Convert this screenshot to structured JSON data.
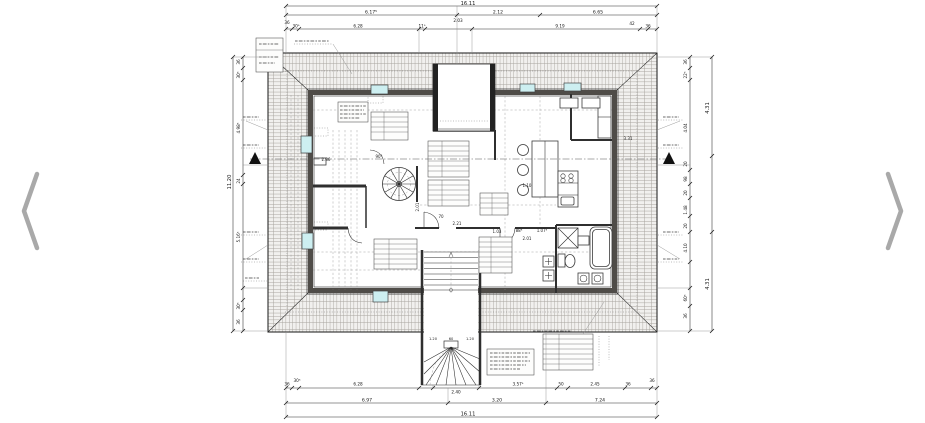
{
  "viewer": {
    "prev_icon": "chevron-left",
    "next_icon": "chevron-right",
    "arrow_color": "#a9a9a9",
    "background": "#ffffff"
  },
  "drawing": {
    "type": "attic floor plan, technical architectural drawing",
    "colors": {
      "line": "#2b2b2b",
      "roof_hatch": "#a8a49e",
      "roof_fill": "#f1f0ee",
      "skylight": "#cdeff1",
      "wall": "#4f4c48"
    },
    "dims": {
      "top": {
        "overall": "16.11",
        "mid": [
          "6.17⁵",
          "2.12",
          "6.65"
        ],
        "detail": [
          "36",
          "30⁵",
          "6.28",
          "11⁵",
          "2.03",
          "9.19",
          "42",
          "36"
        ]
      },
      "bottom": {
        "overall": "16.11",
        "mid": [
          "6.97",
          "3.20",
          "7.24"
        ],
        "detail": [
          "36",
          "30⁵",
          "6.28",
          "2.40",
          "3.57⁵",
          "50",
          "2.45",
          "36",
          "36"
        ]
      },
      "left": {
        "overall": "11.20",
        "detail": [
          "36",
          "30⁵",
          "4.98⁵",
          "24",
          "5.16⁵",
          "30⁵",
          "36"
        ]
      },
      "right": {
        "outer": [
          "4.31",
          "4.31"
        ],
        "inner": [
          "36",
          "22⁵",
          "4.04",
          "20",
          "98",
          "20",
          "1.48",
          "20",
          "4.10",
          "60⁵",
          "36"
        ]
      }
    },
    "stair": {
      "widths": [
        "1.20",
        "60",
        "1.20"
      ]
    },
    "rooms": {
      "labels": [
        "2.86",
        "90°",
        "2.01",
        "70",
        "2.21",
        "1.03",
        "88⁵",
        "1.07⁵",
        "2.01",
        "1.10",
        "3.31"
      ]
    }
  }
}
